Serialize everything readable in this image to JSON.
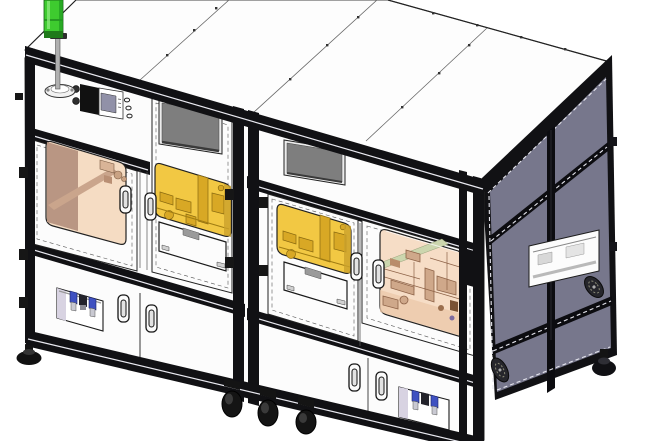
{
  "scene": {
    "kind": "3d-cad-render",
    "subject": "two-module automated machine enclosure",
    "view": "isometric front-left",
    "modules": 2,
    "visible_counts": {
      "hmi_screens": 2,
      "yellow_windows": 2,
      "glass_doors": 2,
      "door_handles": 8,
      "pneumatic_units": 2,
      "cooling_fans": 2,
      "casters": 3,
      "leveling_feet": 2,
      "signal_tower_lights": 1
    }
  },
  "colors": {
    "background": "#ffffff",
    "roof_white": "#fdfdfd",
    "panel_white": "#fcfcfc",
    "frame_black": "#111114",
    "frame_highlight": "#e9e9f0",
    "side_slate": "#77778c",
    "window_yellow": "#f2c843",
    "yellow_machinery": "#d8a825",
    "yellow_machinery_dark": "#8a6a10",
    "window_tan": "#f5dcc3",
    "tan_wall": "#b99683",
    "window_peach": "#f6ddc6",
    "machinery_brown": "#8d6247",
    "machinery_light": "#cfa88a",
    "beam_green": "#ccd6ae",
    "screen_gray": "#7e7e7e",
    "screen_bezel": "#ececec",
    "hmi_screen": "#9191a8",
    "tower_green": "#3ecb2f",
    "tower_green_dark": "#1f7a1a",
    "pneumatic_blue": "#3f51c1",
    "pneumatic_black": "#23232b",
    "pneumatic_gray": "#c9c9d2",
    "recess_lavender": "#d8d3e2",
    "handle_white": "#fafafa",
    "foot_black": "#141414",
    "line_dark": "#222222"
  }
}
